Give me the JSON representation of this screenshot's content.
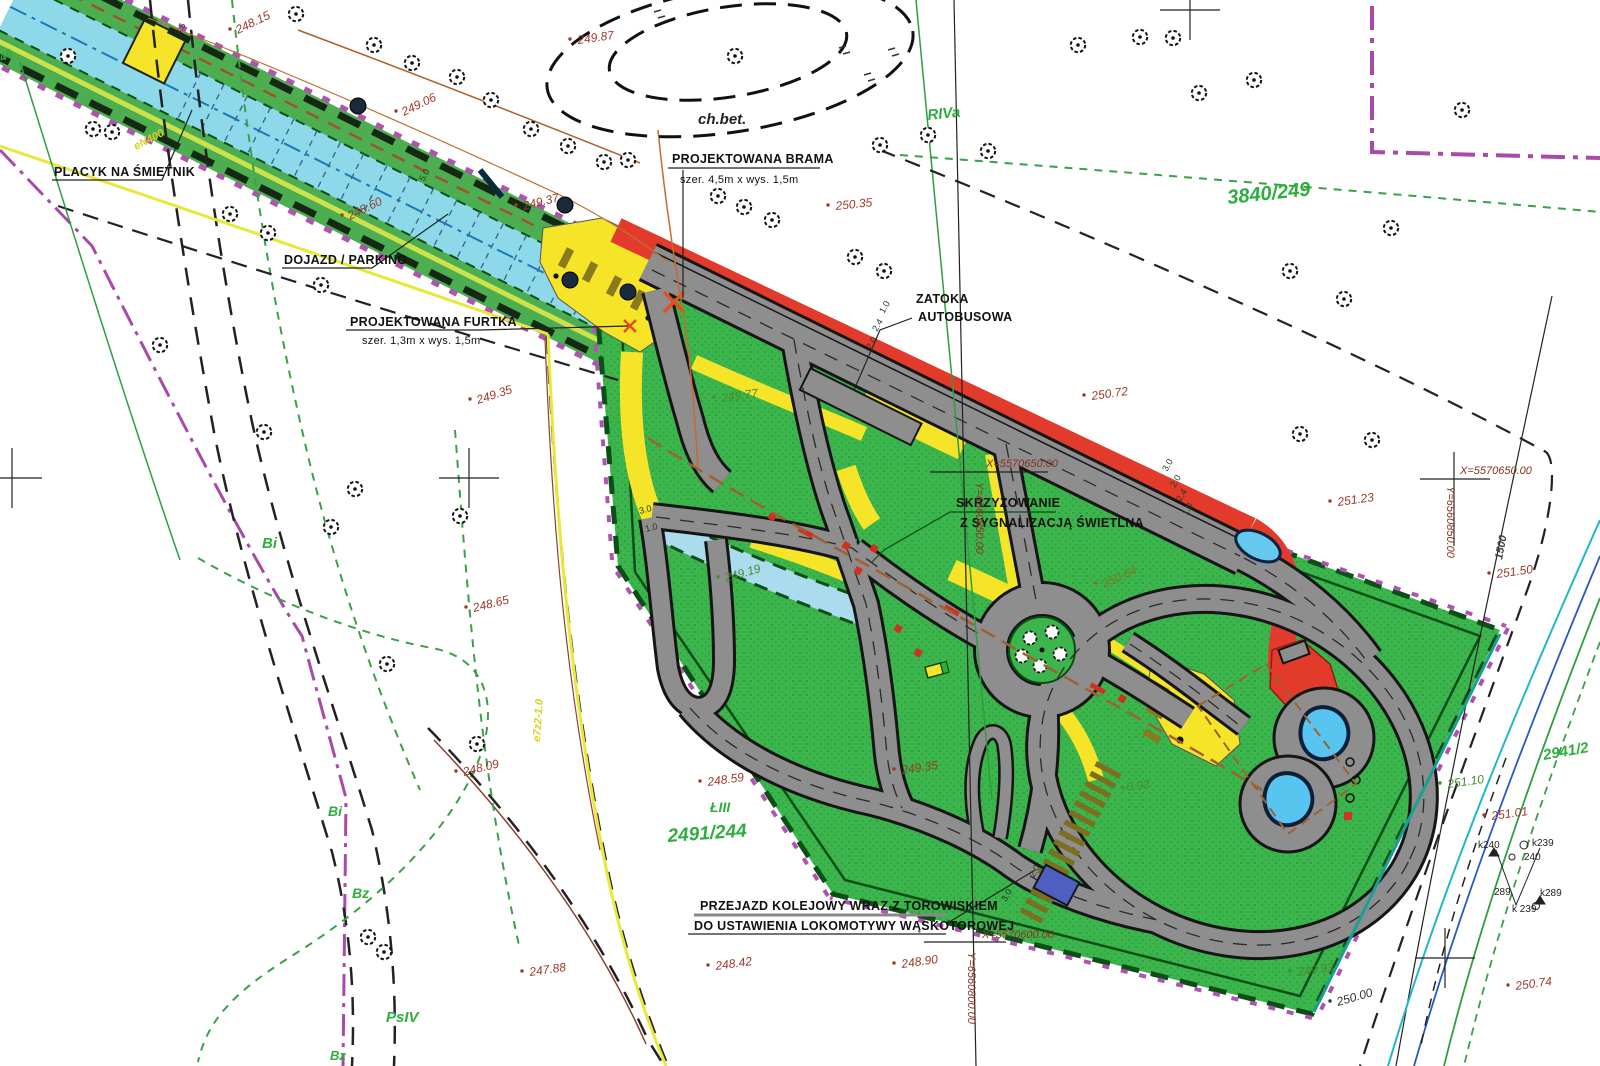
{
  "callouts": {
    "placyk": {
      "text": "PLACYK NA ŚMIETNIK"
    },
    "dojazd": {
      "text": "DOJAZD / PARKING"
    },
    "furtka": {
      "line1": "PROJEKTOWANA FURTKA",
      "line2": "szer. 1,3m x wys. 1,5m"
    },
    "brama": {
      "line1": "PROJEKTOWANA BRAMA",
      "line2": "szer. 4,5m x wys. 1,5m"
    },
    "zatoka": {
      "line1": "ZATOKA",
      "line2": "AUTOBUSOWA"
    },
    "skrzyzowanie": {
      "line1": "SKRZYŻOWANIE",
      "line2": "Z SYGNALIZACJĄ ŚWIETLNĄ"
    },
    "przejazd": {
      "line1": "PRZEJAZD KOLEJOWY WRAZ Z TOROWISKIEM",
      "line2": "DO USTAWIENIA LOKOMOTYWY WĄSKOTOROWEJ"
    },
    "ch_bet": {
      "text": "ch.bet."
    }
  },
  "coordinates": {
    "c1": {
      "x": "X=5570650.00",
      "y": "Y=6560850.00"
    },
    "c2": {
      "x": "X=5570650.00",
      "y": "Y=6560850.00"
    },
    "c3": {
      "x": "X=5570600.00",
      "y": "Y=6560800.00"
    }
  },
  "elevations": [
    {
      "v": "249.87",
      "x": 578,
      "y": 44,
      "r": -8
    },
    {
      "v": "248.15",
      "x": 238,
      "y": 34,
      "r": -26
    },
    {
      "v": "249.06",
      "x": 404,
      "y": 116,
      "r": -26
    },
    {
      "v": "248.60",
      "x": 350,
      "y": 220,
      "r": -26
    },
    {
      "v": "249.37",
      "x": 524,
      "y": 210,
      "r": -14
    },
    {
      "v": "250.35",
      "x": 836,
      "y": 210,
      "r": -6
    },
    {
      "v": "250.72",
      "x": 1092,
      "y": 400,
      "r": -8
    },
    {
      "v": "249.35",
      "x": 478,
      "y": 404,
      "r": -18
    },
    {
      "v": "248.65",
      "x": 474,
      "y": 612,
      "r": -14
    },
    {
      "v": "248.09",
      "x": 464,
      "y": 776,
      "r": -14
    },
    {
      "v": "247.88",
      "x": 530,
      "y": 976,
      "r": -8
    },
    {
      "v": "248.42",
      "x": 716,
      "y": 970,
      "r": -8
    },
    {
      "v": "248.90",
      "x": 902,
      "y": 968,
      "r": -8
    },
    {
      "v": "248.59",
      "x": 708,
      "y": 786,
      "r": -8
    },
    {
      "v": "249.35",
      "x": 902,
      "y": 774,
      "r": -8
    },
    {
      "v": "249.19",
      "x": 726,
      "y": 582,
      "r": -16,
      "cls": "green"
    },
    {
      "v": "249.77",
      "x": 722,
      "y": 402,
      "r": -8,
      "cls": "green"
    },
    {
      "v": "250.64",
      "x": 1104,
      "y": 588,
      "r": -24,
      "cls": "olive"
    },
    {
      "v": "251.23",
      "x": 1338,
      "y": 506,
      "r": -8
    },
    {
      "v": "251.50",
      "x": 1497,
      "y": 578,
      "r": -8
    },
    {
      "v": "251.10",
      "x": 1448,
      "y": 788,
      "r": -8,
      "cls": "green"
    },
    {
      "v": "251.01",
      "x": 1492,
      "y": 820,
      "r": -8
    },
    {
      "v": "250.74",
      "x": 1516,
      "y": 990,
      "r": -8
    },
    {
      "v": "249.93",
      "x": 1298,
      "y": 976,
      "r": -8,
      "cls": "green"
    },
    {
      "v": "250.00",
      "x": 1338,
      "y": 1006,
      "r": -16,
      "cls": "dark"
    },
    {
      "v": "+0.92",
      "x": 1120,
      "y": 792,
      "r": -8,
      "cls": "green"
    }
  ],
  "parcels": [
    {
      "v": "3840/249",
      "x": 1228,
      "y": 204,
      "r": -6,
      "s": 20
    },
    {
      "v": "RIVa",
      "x": 928,
      "y": 120,
      "r": -6,
      "s": 15
    },
    {
      "v": "Bi",
      "x": 262,
      "y": 548,
      "r": 0,
      "s": 15
    },
    {
      "v": "Bi",
      "x": 328,
      "y": 816,
      "r": 0,
      "s": 14
    },
    {
      "v": "Bz",
      "x": 352,
      "y": 898,
      "r": 0,
      "s": 14
    },
    {
      "v": "PsIV",
      "x": 386,
      "y": 1022,
      "r": 0,
      "s": 15
    },
    {
      "v": "Bz",
      "x": 330,
      "y": 1060,
      "r": 0,
      "s": 13
    },
    {
      "v": "ŁIII",
      "x": 710,
      "y": 812,
      "r": 0,
      "s": 14
    },
    {
      "v": "2491/244",
      "x": 668,
      "y": 842,
      "r": -4,
      "s": 19
    },
    {
      "v": "2941/2",
      "x": 1544,
      "y": 760,
      "r": -10,
      "s": 15
    },
    {
      "v": "46",
      "x": 2,
      "y": 62,
      "r": -30,
      "s": 12
    }
  ],
  "survey_points": [
    {
      "v": "k240",
      "x": 1478,
      "y": 848
    },
    {
      "v": "k239",
      "x": 1532,
      "y": 846
    },
    {
      "v": "240",
      "x": 1524,
      "y": 860
    },
    {
      "v": "289",
      "x": 1494,
      "y": 895
    },
    {
      "v": "k289",
      "x": 1540,
      "y": 896
    },
    {
      "v": "k 239",
      "x": 1512,
      "y": 912
    }
  ],
  "utilities": [
    {
      "v": "eN400",
      "x": 136,
      "y": 150,
      "r": -27,
      "cls": "yellow"
    },
    {
      "v": "e7z2-1.0",
      "x": 540,
      "y": 742,
      "r": -86,
      "cls": "yellow"
    },
    {
      "v": "1500",
      "x": 1502,
      "y": 560,
      "r": -79,
      "cls": "dark"
    }
  ],
  "dimensions": [
    {
      "v": "3.5",
      "x": 180,
      "y": 36,
      "r": -62
    },
    {
      "v": "5.0",
      "x": 424,
      "y": 182,
      "r": -62
    },
    {
      "v": "1.0",
      "x": 884,
      "y": 314,
      "r": -60
    },
    {
      "v": "2.4",
      "x": 877,
      "y": 332,
      "r": -60
    },
    {
      "v": "2.0",
      "x": 871,
      "y": 350,
      "r": -60
    },
    {
      "v": "3.0",
      "x": 1167,
      "y": 472,
      "r": -60
    },
    {
      "v": "2.0",
      "x": 1175,
      "y": 488,
      "r": -60
    },
    {
      "v": "2.4",
      "x": 1181,
      "y": 502,
      "r": -60
    },
    {
      "v": "1.0",
      "x": 1187,
      "y": 516,
      "r": -60
    },
    {
      "v": "3.0",
      "x": 640,
      "y": 514,
      "r": -14
    },
    {
      "v": "1.0",
      "x": 646,
      "y": 532,
      "r": -14
    },
    {
      "v": "2.0",
      "x": 1034,
      "y": 878,
      "r": -60
    },
    {
      "v": "3.0",
      "x": 1006,
      "y": 902,
      "r": -60
    }
  ],
  "colors": {
    "site_green": "#3cb54d",
    "strip_green": "#4cae50",
    "parking_cyan": "#8ed9e9",
    "stream_blue": "#aadcee",
    "road_gray": "#8e8e8e",
    "road_edge": "#151515",
    "sidewalk_yellow": "#f5e428",
    "bus_lane_red": "#e23b2c",
    "boundary_magenta": "#b052b0",
    "border_dark_green": "#0b4f17",
    "railway_olive": "#7c6f1f",
    "pool_blue": "#58c4f0",
    "crossing_blue": "#4f5fc0",
    "elevation_red": "#9c3a28",
    "parcel_green": "#2fae3e"
  }
}
